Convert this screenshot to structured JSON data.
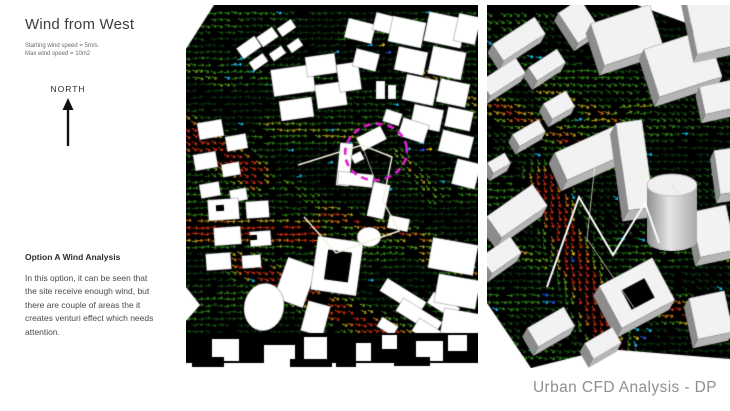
{
  "slide": {
    "title": "Wind from West",
    "wind_params": {
      "line1": "Starting wind speed = 5m/s.",
      "line2": "Max wind speed = 10m2"
    },
    "compass": {
      "label": "NORTH"
    },
    "analysis": {
      "heading": "Option A Wind Analysis",
      "body": "In this option, it can be seen that\nthe site receive enough wind, but\nthere are couple of areas the it\ncreates venturi effect which needs\nattention."
    },
    "footer": "Urban CFD Analysis - DP"
  },
  "panels": {
    "plan_view": {
      "label": "plan-view-wind-vector-field"
    },
    "perspective_view": {
      "label": "perspective-view-wind-vector-field"
    }
  },
  "colors": {
    "page_background": "#ffffff",
    "ground": "#000000",
    "building_plan": "#ffffff",
    "building_3d_top": "#f2f2f2",
    "building_3d_side_dark": "#8c8c8c",
    "building_3d_side_light": "#b5b5b5",
    "annotation_magenta": "#e11fd0",
    "site_outline": "#f2f0dc",
    "vector_low": "#0b2f0e",
    "vector_mid": "#2b7a16",
    "vector_high": "#c06a12",
    "vector_max": "#c02a0e",
    "vector_accent_cyan": "#19b5d8",
    "vector_accent_blue": "#2255dd",
    "vector_accent_yellow": "#d8c818",
    "footer_text": "#8f8f8f"
  }
}
